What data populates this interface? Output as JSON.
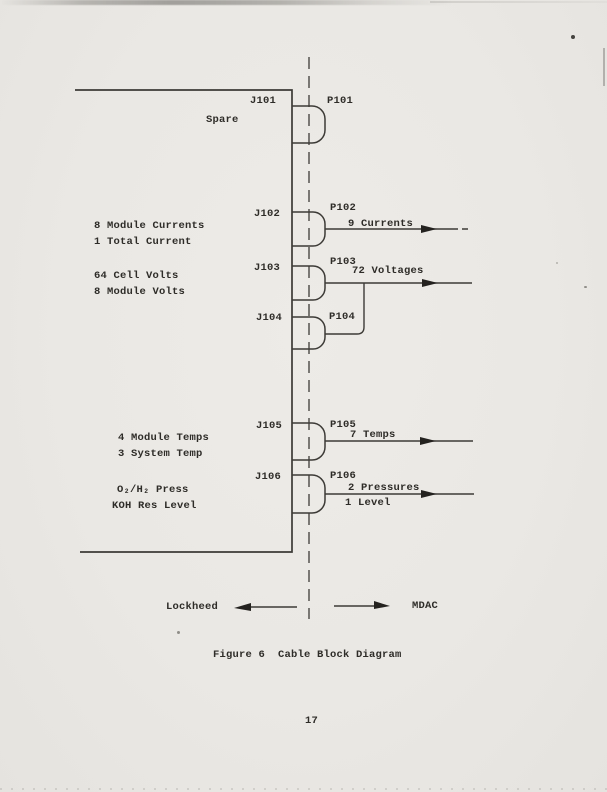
{
  "colors": {
    "paper": "#ebe9e5",
    "ink": "#2e2c28",
    "line": "#3d3b37"
  },
  "page": {
    "figure_caption": "Figure 6  Cable Block Diagram",
    "page_number": "17"
  },
  "diagram": {
    "sides": {
      "left": "Lockheed",
      "right": "MDAC"
    },
    "connectors": [
      {
        "jack": "J101",
        "plug": "P101",
        "signals": [
          "Spare"
        ],
        "outputs": []
      },
      {
        "jack": "J102",
        "plug": "P102",
        "signals": [
          "8 Module Currents",
          "1 Total Current"
        ],
        "outputs": [
          "9 Currents"
        ]
      },
      {
        "jack": "J103",
        "plug": "P103",
        "signals": [
          "64 Cell Volts",
          "8 Module Volts"
        ],
        "outputs": [
          "72 Voltages"
        ]
      },
      {
        "jack": "J104",
        "plug": "P104",
        "signals": [],
        "outputs": []
      },
      {
        "jack": "J105",
        "plug": "P105",
        "signals": [
          "4 Module Temps",
          "3 System Temp"
        ],
        "outputs": [
          "7 Temps"
        ]
      },
      {
        "jack": "J106",
        "plug": "P106",
        "signals": [
          "O₂/H₂ Press",
          "KOH Res Level"
        ],
        "outputs": [
          "2 Pressures",
          "1 Level"
        ]
      }
    ]
  }
}
